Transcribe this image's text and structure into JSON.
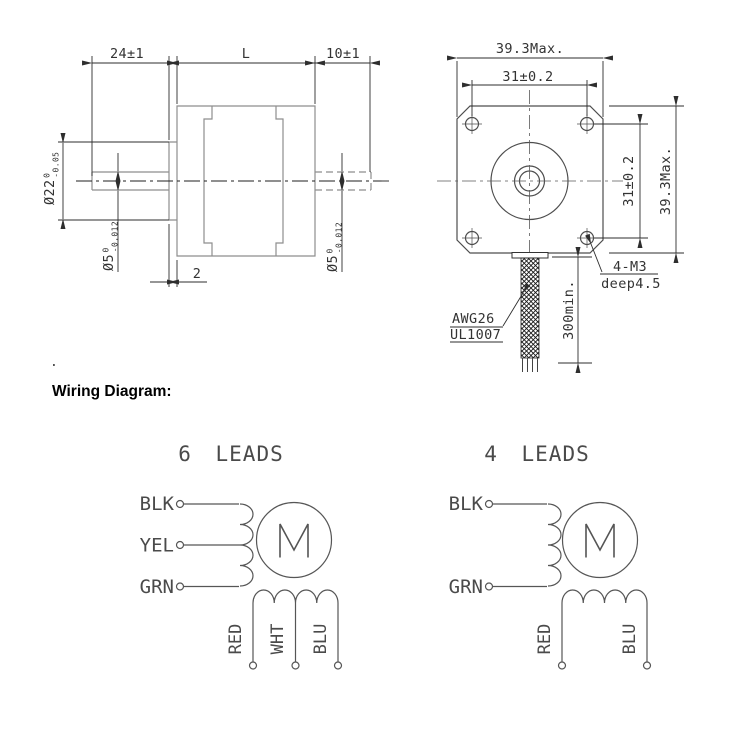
{
  "drawing": {
    "side_view": {
      "dim_front": "24±1",
      "dim_body": "L",
      "dim_rear": "10±1",
      "boss_dia": "Ø22",
      "boss_tol_top": "0",
      "boss_tol_bot": "-0.05",
      "shaft_dia": "Ø5",
      "shaft_tol_top": "0",
      "shaft_tol_bot": "-0.012",
      "rear_shaft_dia": "Ø5",
      "rear_shaft_tol_top": "0",
      "rear_shaft_tol_bot": "-0.012",
      "boss_depth": "2"
    },
    "front_view": {
      "dim_width": "39.3Max.",
      "dim_holes_h": "31±0.2",
      "dim_holes_v": "31±0.2",
      "dim_height": "39.3Max.",
      "holes_note_line1": "4-M3",
      "holes_note_line2": "deep4.5",
      "cable_note_line1": "AWG26",
      "cable_note_line2": "UL1007",
      "lead_length": "300min."
    },
    "stray_dot": "."
  },
  "wiring": {
    "heading": "Wiring Diagram:",
    "six": {
      "title": "6 LEADS",
      "motor_label": "M",
      "left_leads": [
        "BLK",
        "YEL",
        "GRN"
      ],
      "bottom_leads": [
        "RED",
        "WHT",
        "BLU"
      ]
    },
    "four": {
      "title": "4 LEADS",
      "motor_label": "M",
      "left_leads": [
        "BLK",
        "GRN"
      ],
      "bottom_leads": [
        "RED",
        "BLU"
      ]
    }
  }
}
